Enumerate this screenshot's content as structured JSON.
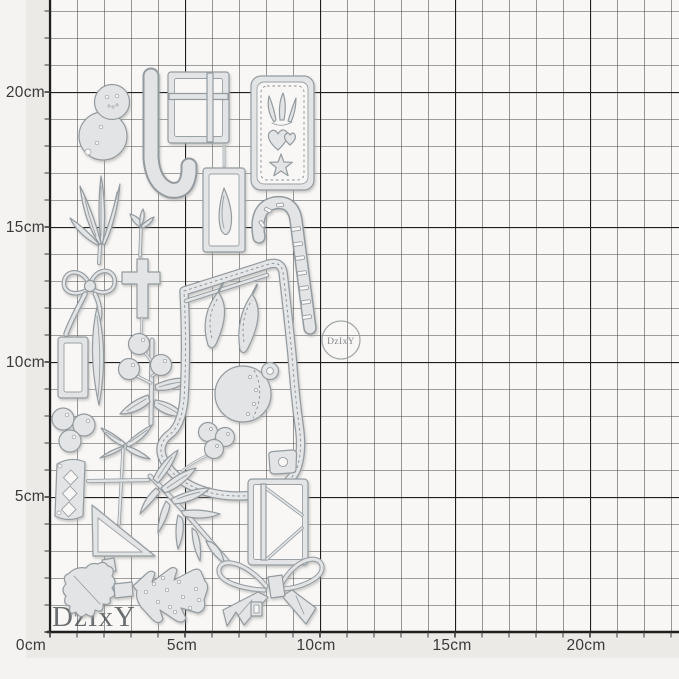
{
  "image_type": "product photo of a christmas metal cutting-die set on a centimetre grid mat",
  "ruler": {
    "unit": "cm",
    "left_labels": [
      "20cm",
      "15cm",
      "10cm",
      "5cm"
    ],
    "bottom_labels": [
      "0cm",
      "5cm",
      "10cm",
      "15cm",
      "20cm"
    ]
  },
  "grid": {
    "minor_step_cm": 1,
    "major_step_cm": 5
  },
  "watermark": {
    "circle_text": "DzIxY",
    "corner_text": "DzIxY"
  },
  "colors": {
    "mat_background": "#f8f7f5",
    "margin_strip": "#ebeae7",
    "grid_minor_line": "#454545",
    "grid_major_line": "#1e1e1e",
    "die_fill": "#e2e4e5",
    "die_stroke": "#949ba0",
    "label_text": "#3a3a3a",
    "watermark_gray": "#83878a"
  },
  "dies": [
    "snowman",
    "candy cane",
    "gift box",
    "stitched tag with candles heart and star",
    "leaf sprig",
    "bud stem",
    "small bow",
    "cross",
    "slim leaf",
    "small rectangle frame",
    "berry branch",
    "berry cluster",
    "crossed-leaf sprig",
    "stocking",
    "stitched leaves",
    "bauble ornament with cap",
    "berry trio",
    "mini basket cap",
    "pennant banner with diamonds",
    "triangle frame",
    "pine branch",
    "holly leaf",
    "christmas tree",
    "envelope gift box",
    "large bow",
    "striped candy cane",
    "teardrop frame"
  ]
}
